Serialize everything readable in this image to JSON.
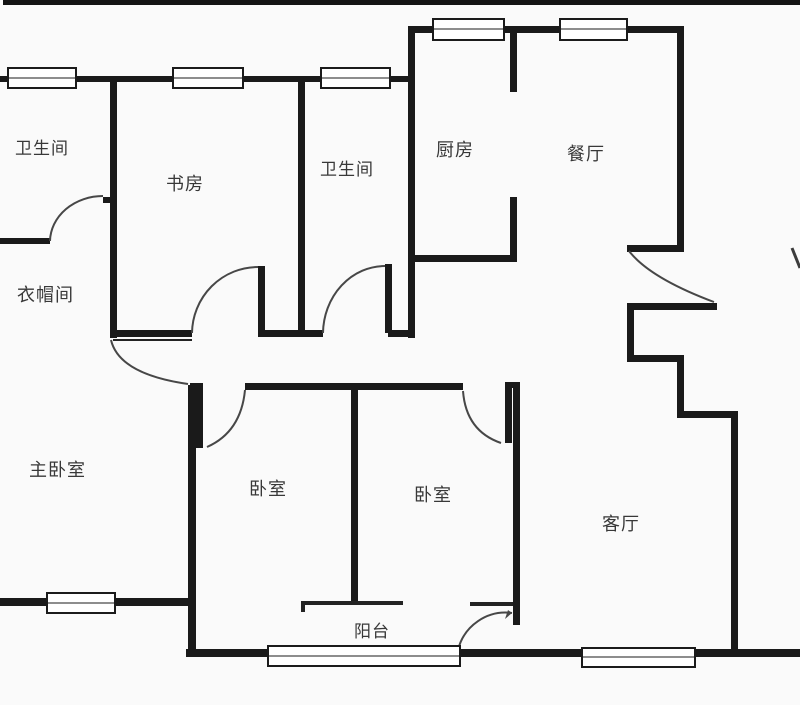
{
  "figure_type": "apartment-floor-plan",
  "rooms": [
    {
      "id": "bathroom-1",
      "label": "卫生间"
    },
    {
      "id": "study",
      "label": "书房"
    },
    {
      "id": "bathroom-2",
      "label": "卫生间"
    },
    {
      "id": "kitchen",
      "label": "厨房"
    },
    {
      "id": "dining-room",
      "label": "餐厅"
    },
    {
      "id": "cloakroom",
      "label": "衣帽间"
    },
    {
      "id": "master-bedroom",
      "label": "主卧室"
    },
    {
      "id": "bedroom-1",
      "label": "卧室"
    },
    {
      "id": "bedroom-2",
      "label": "卧室"
    },
    {
      "id": "living-room",
      "label": "客厅"
    },
    {
      "id": "balcony",
      "label": "阳台"
    }
  ],
  "symbols": {
    "window_count": 8,
    "door_arc_count": 8
  },
  "colors": {
    "wall": "#1a1a1a",
    "background": "#fafafa",
    "text": "#383838",
    "door_arc": "#474747",
    "window_fill": "#ffffff"
  }
}
